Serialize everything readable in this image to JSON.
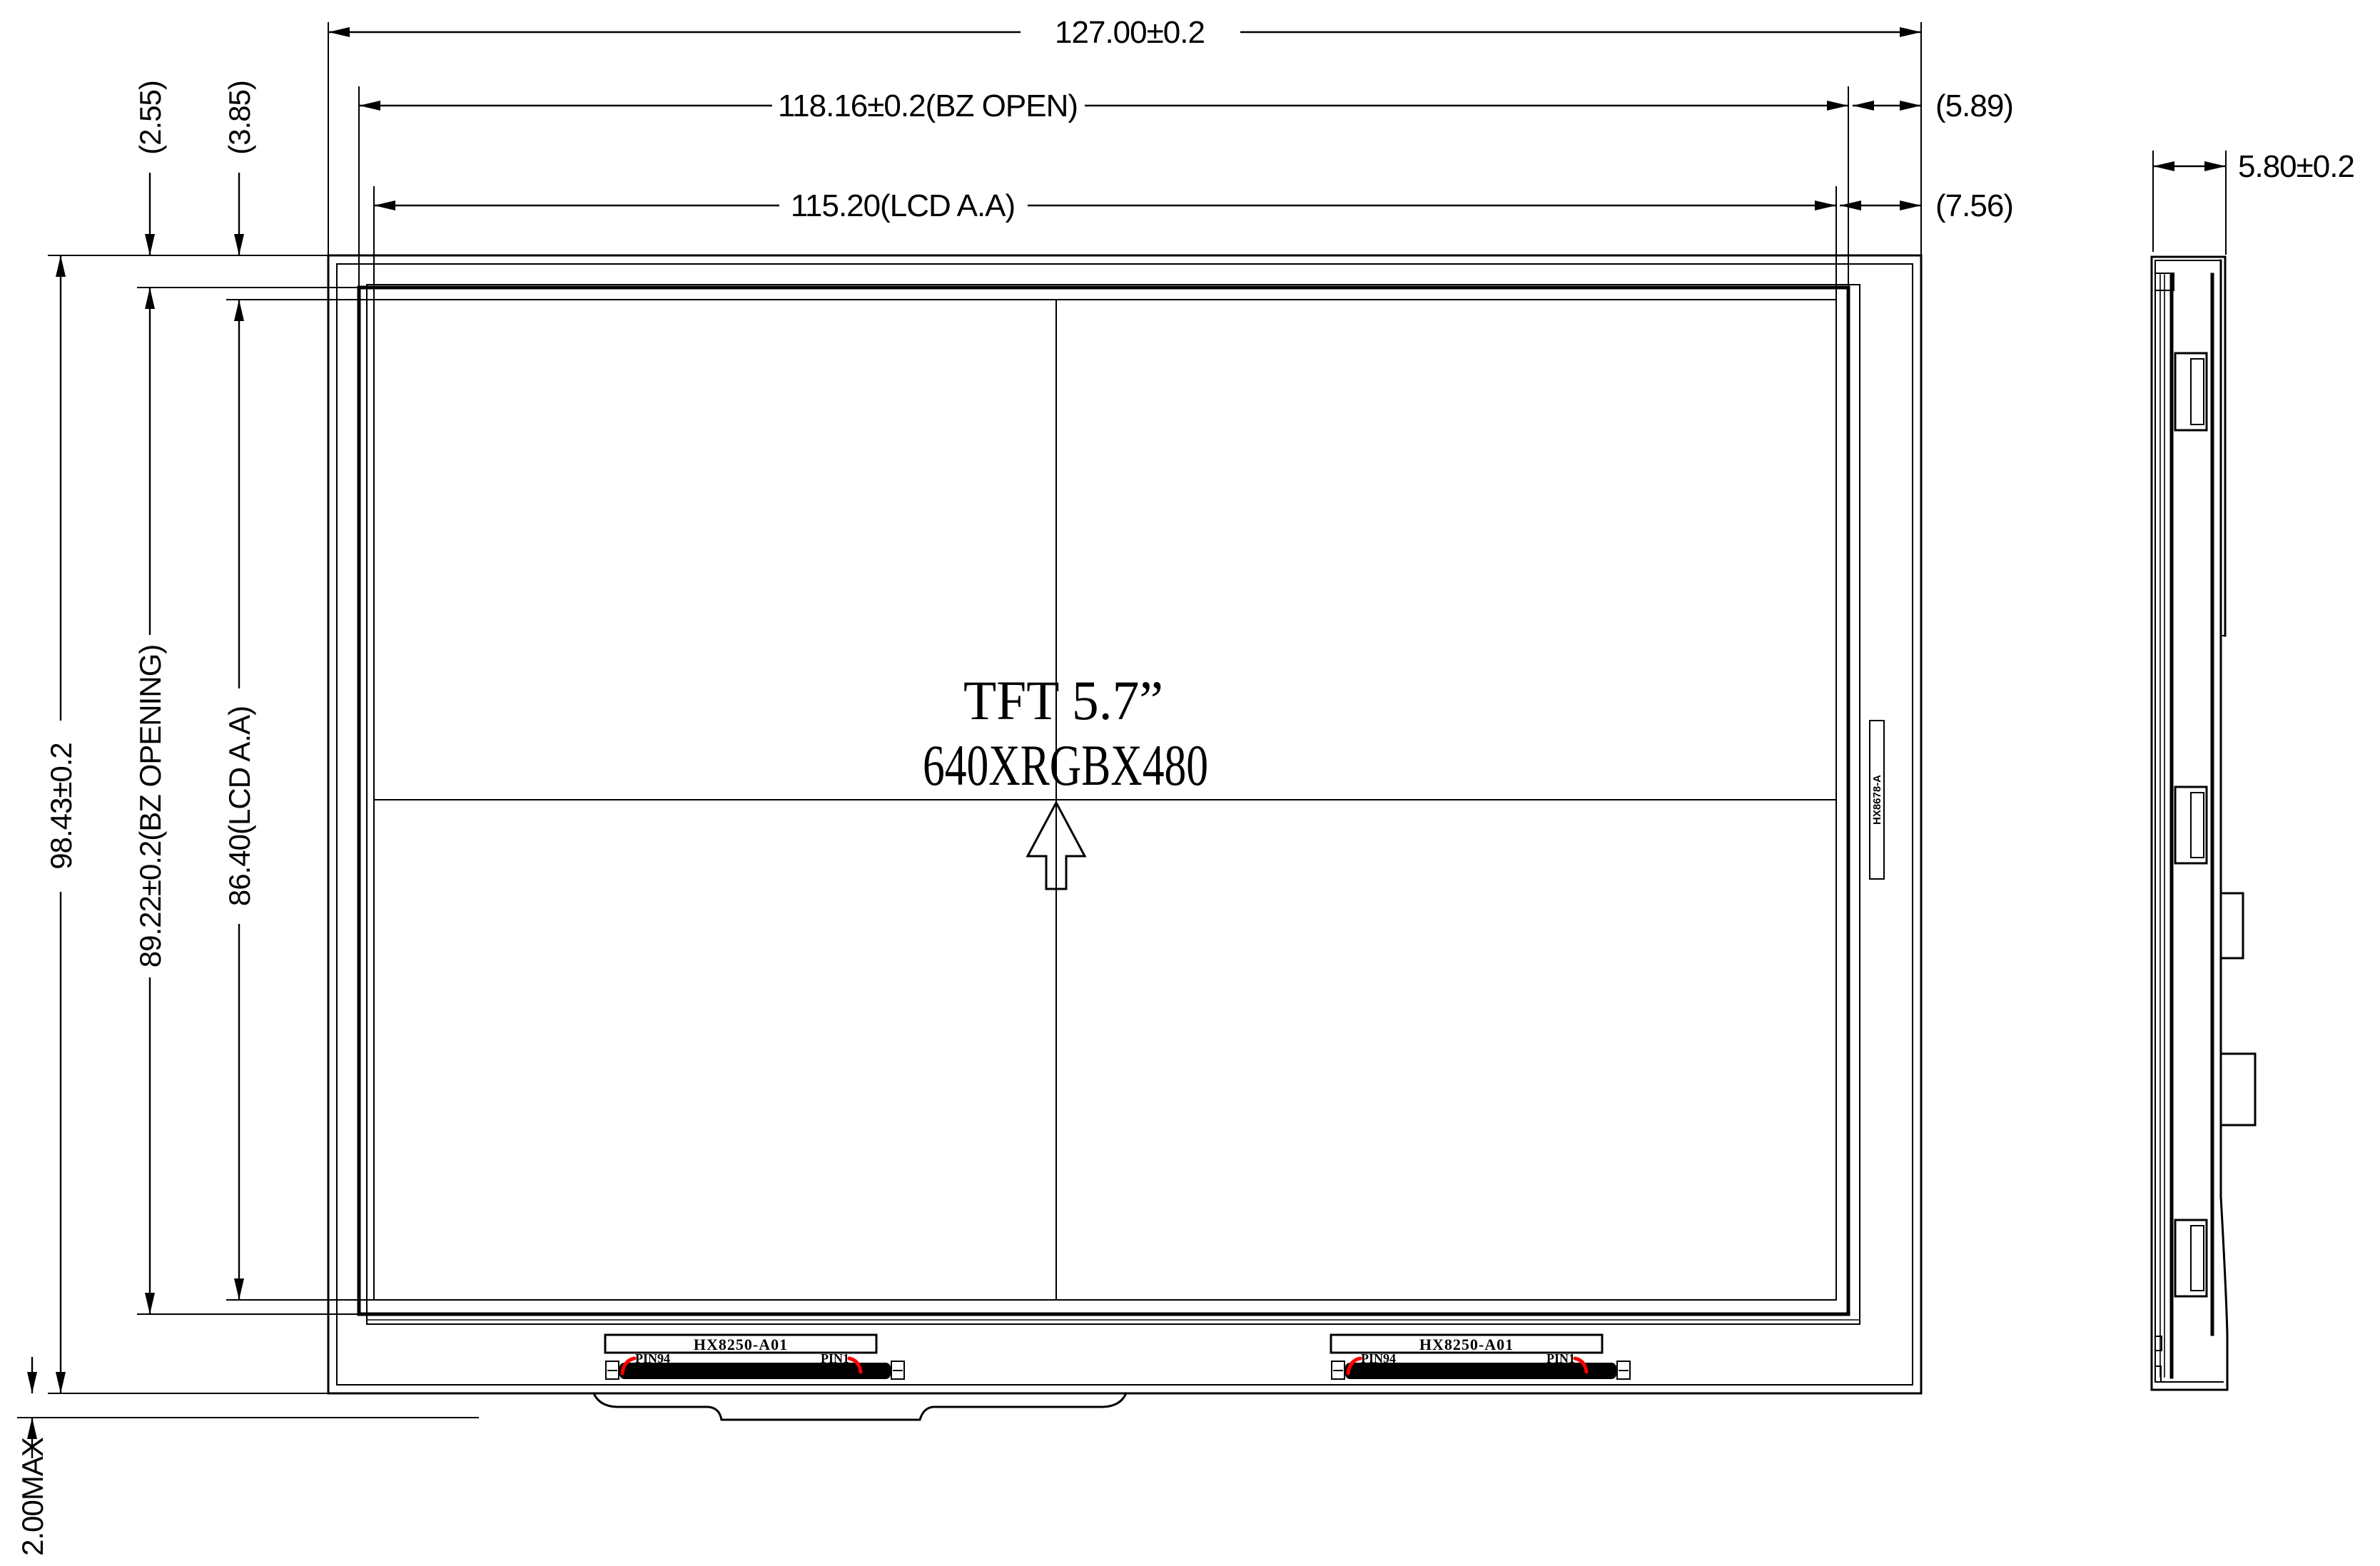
{
  "drawing": {
    "view_front": "front view",
    "view_side": "side view",
    "panel": {
      "title": "TFT  5.7”",
      "resolution": "640XRGBX480",
      "panel_model": "HX8678-A"
    },
    "dimensions": {
      "overall_width": "127.00±0.2",
      "bezel_open_width": "118.16±0.2(BZ OPEN)",
      "lcd_aa_width": "115.20(LCD A.A)",
      "right_gap_bezel": "(5.89)",
      "right_gap_aa": "(7.56)",
      "thickness": "5.80±0.2",
      "top_gap_bezel": "(2.55)",
      "top_gap_aa": "(3.85)",
      "overall_height": "98.43±0.2",
      "bezel_open_height": "89.22±0.2(BZ OPENING)",
      "lcd_aa_height": "86.40(LCD A.A)",
      "fpc_protrusion": "2.00MAX"
    },
    "connector": {
      "model": "HX8250-A01",
      "pin_first": "PIN94",
      "pin_last": "PIN1"
    },
    "colors": {
      "line": "#000000",
      "pin_marker": "#ff0000",
      "background": "#ffffff"
    }
  }
}
